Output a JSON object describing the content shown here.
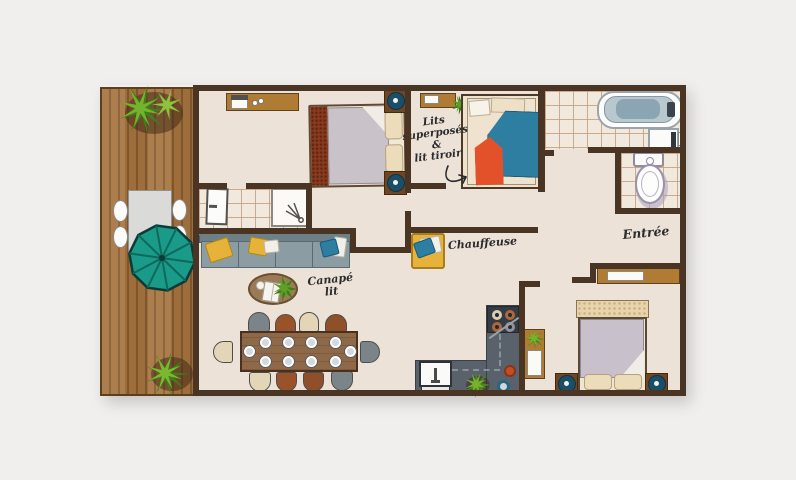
{
  "labels": {
    "bunk": [
      "Lits",
      "superposés",
      "&",
      "lit tiroir"
    ],
    "chauffeuse": "Chauffeuse",
    "sofa": [
      "Canapé",
      "lit"
    ],
    "entry": "Entrée"
  },
  "colors": {
    "background": "#f0efed",
    "floor": "#ece2d7",
    "wall": "#4a3423",
    "deck_wood": "#a77440",
    "accent_teal": "#1a9a89",
    "accent_orange": "#e2512a",
    "accent_blue": "#2d7ea0",
    "accent_yellow": "#e7b23a",
    "counter_grey": "#59616b"
  }
}
